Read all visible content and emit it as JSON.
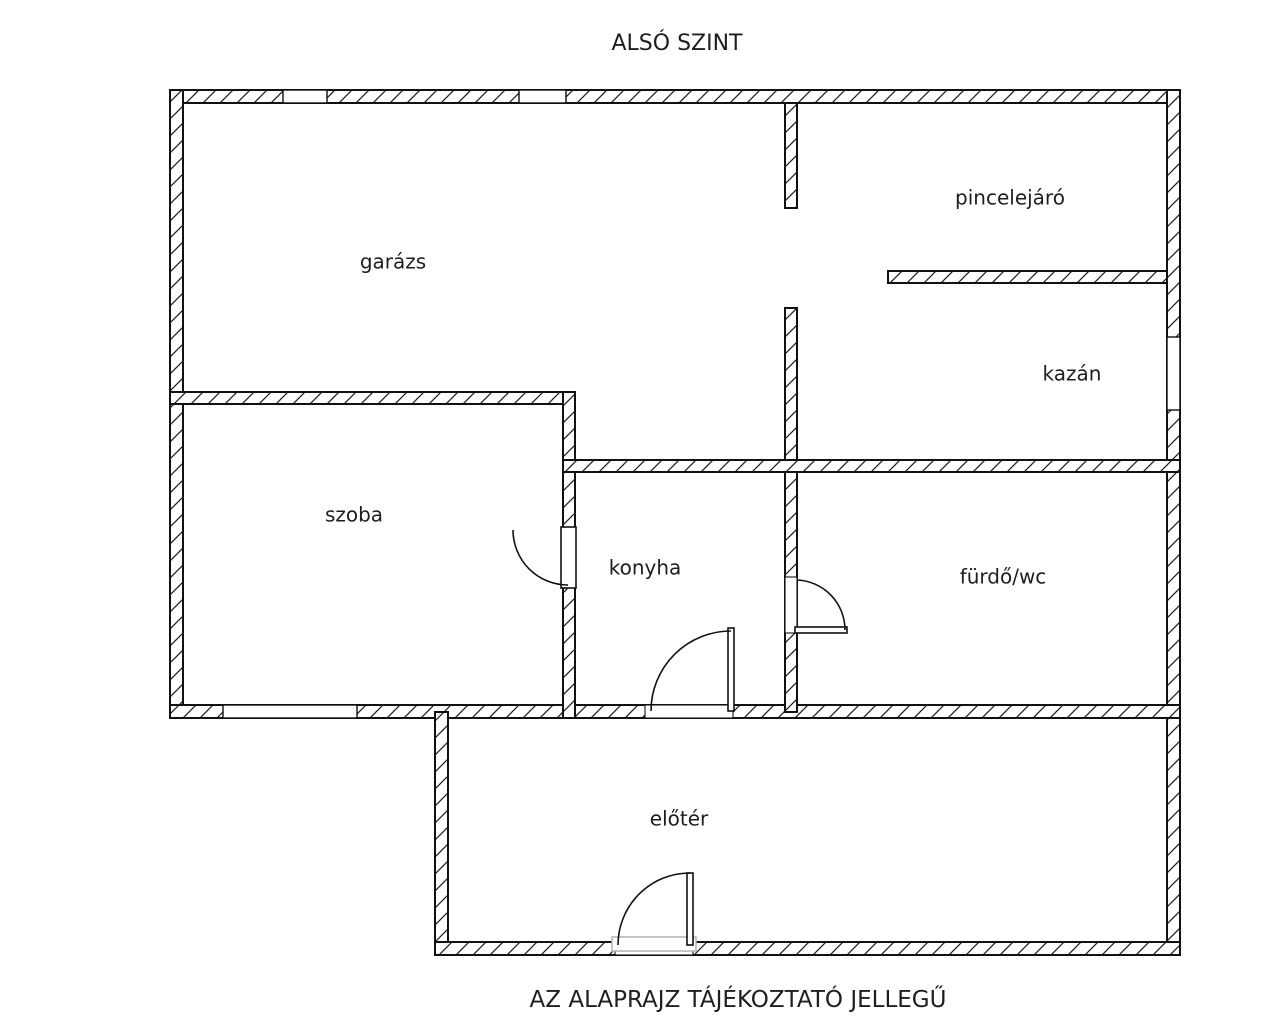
{
  "titles": {
    "top": "ALSÓ SZINT",
    "bottom": "AZ ALAPRAJZ TÁJÉKOZTATÓ JELLEGŰ"
  },
  "colors": {
    "background": "#ffffff",
    "wall_stroke": "#111111",
    "hatch_line": "#1a1a1a",
    "text": "#1e1e1e",
    "threshold": "#b4b4b4"
  },
  "floorplan": {
    "canvas": {
      "width": 1269,
      "height": 1024
    },
    "rooms": [
      {
        "id": "garazs",
        "label": "garázs",
        "x": 393,
        "y": 263
      },
      {
        "id": "pincelejaro",
        "label": "pincelejáró",
        "x": 1010,
        "y": 199
      },
      {
        "id": "kazan",
        "label": "kazán",
        "x": 1072,
        "y": 375
      },
      {
        "id": "szoba",
        "label": "szoba",
        "x": 354,
        "y": 516
      },
      {
        "id": "konyha",
        "label": "konyha",
        "x": 645,
        "y": 569
      },
      {
        "id": "furdo-wc",
        "label": "fürdő/wc",
        "x": 1003,
        "y": 578
      },
      {
        "id": "eloter",
        "label": "előtér",
        "x": 679,
        "y": 820
      }
    ],
    "walls": [
      {
        "name": "exterior-top",
        "x": 170,
        "y": 90,
        "w": 1010,
        "h": 13
      },
      {
        "name": "exterior-left",
        "x": 170,
        "y": 90,
        "w": 13,
        "h": 628
      },
      {
        "name": "exterior-right",
        "x": 1167,
        "y": 90,
        "w": 13,
        "h": 865
      },
      {
        "name": "mid-horizontal",
        "x": 170,
        "y": 705,
        "w": 1010,
        "h": 13
      },
      {
        "name": "eloter-left",
        "x": 435,
        "y": 712,
        "w": 13,
        "h": 243
      },
      {
        "name": "eloter-bottom",
        "x": 435,
        "y": 942,
        "w": 745,
        "h": 13
      },
      {
        "name": "garage-pince-upper",
        "x": 785,
        "y": 103,
        "w": 12,
        "h": 105
      },
      {
        "name": "garage-pince-lower",
        "x": 785,
        "y": 308,
        "w": 12,
        "h": 154
      },
      {
        "name": "konyha-furdo-divider",
        "x": 785,
        "y": 460,
        "w": 12,
        "h": 252
      },
      {
        "name": "pince-kazan-divider",
        "x": 888,
        "y": 271,
        "w": 279,
        "h": 12
      },
      {
        "name": "szoba-top",
        "x": 170,
        "y": 392,
        "w": 405,
        "h": 12
      },
      {
        "name": "szoba-right",
        "x": 563,
        "y": 392,
        "w": 12,
        "h": 326
      },
      {
        "name": "konyha-kazan-top",
        "x": 563,
        "y": 460,
        "w": 617,
        "h": 12
      }
    ],
    "windows": [
      {
        "name": "garage-window-1",
        "x": 283,
        "y": 90,
        "w": 44,
        "h": 13
      },
      {
        "name": "garage-window-2",
        "x": 519,
        "y": 90,
        "w": 47,
        "h": 13
      },
      {
        "name": "kazan-window",
        "x": 1167,
        "y": 337,
        "w": 13,
        "h": 73
      },
      {
        "name": "szoba-window",
        "x": 223,
        "y": 705,
        "w": 134,
        "h": 13
      }
    ],
    "doors": [
      {
        "name": "szoba-door",
        "leaf": {
          "x": 561,
          "y": 527,
          "w": 15,
          "h": 61
        },
        "arc": "M 513 530 A 55 55 0 0 0 568 585"
      },
      {
        "name": "konyha-door",
        "opening": {
          "x": 645,
          "y": 705,
          "w": 88,
          "h": 13
        },
        "leaf": {
          "x": 728,
          "y": 628,
          "w": 6,
          "h": 83
        },
        "arc": "M 651 711 A 80 80 0 0 1 731 631"
      },
      {
        "name": "furdo-door",
        "opening": {
          "x": 785,
          "y": 577,
          "w": 12,
          "h": 56
        },
        "leaf": {
          "x": 795,
          "y": 627,
          "w": 52,
          "h": 6
        },
        "arc": "M 845 630 A 50 50 0 0 0 797 580"
      },
      {
        "name": "entrance-door",
        "opening": {
          "x": 615,
          "y": 942,
          "w": 78,
          "h": 13
        },
        "threshold": {
          "x": 612,
          "y": 937,
          "w": 84,
          "h": 14
        },
        "leaf": {
          "x": 687,
          "y": 873,
          "w": 6,
          "h": 72
        },
        "arc": "M 618 945 A 72 72 0 0 1 690 873"
      }
    ]
  }
}
